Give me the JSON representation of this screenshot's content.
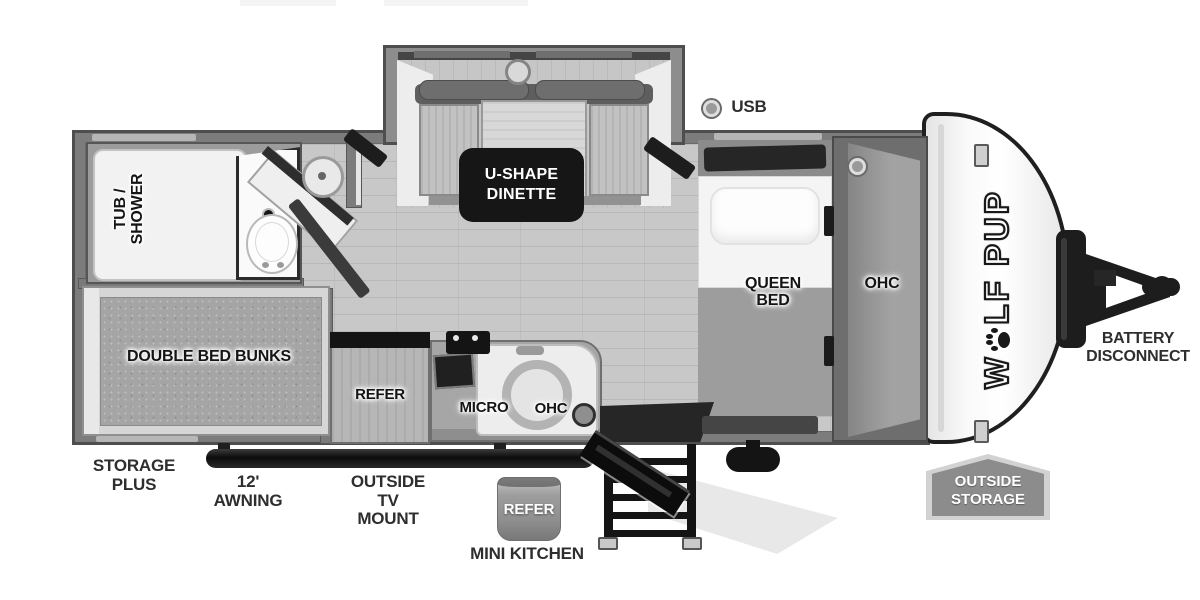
{
  "meta": {
    "title": "Wolf Pup travel trailer floor plan"
  },
  "slide": {
    "dinette_line1": "U-SHAPE",
    "dinette_line2": "DINETTE"
  },
  "indicators": {
    "usb_label": "USB"
  },
  "bathroom": {
    "tub_shower_line1": "TUB /",
    "tub_shower_line2": "SHOWER"
  },
  "bunks": {
    "label": "DOUBLE BED BUNKS"
  },
  "kitchen": {
    "refer_label": "REFER",
    "micro_label": "MICRO",
    "ohc_label": "OHC"
  },
  "bedroom": {
    "queen_line1": "QUEEN",
    "queen_line2": "BED",
    "ohc_label": "OHC"
  },
  "logo": {
    "prefix": "W",
    "suffix": "LF PUP"
  },
  "exterior": {
    "storage_plus_line1": "STORAGE",
    "storage_plus_line2": "PLUS",
    "awning_label": "12' AWNING",
    "tv_mount_line1": "OUTSIDE",
    "tv_mount_line2": "TV MOUNT",
    "mini_kitchen_refer": "REFER",
    "mini_kitchen_label": "MINI KITCHEN",
    "outside_storage_line1": "OUTSIDE",
    "outside_storage_line2": "STORAGE",
    "battery_line1": "BATTERY",
    "battery_line2": "DISCONNECT"
  },
  "colors": {
    "wall": "#7c7c7c",
    "wall_outline": "#4e4e4e",
    "floor": "#c8c8c8",
    "accent_black": "#161616",
    "tag_gray": "#8c8c8c",
    "background": "#ffffff"
  }
}
